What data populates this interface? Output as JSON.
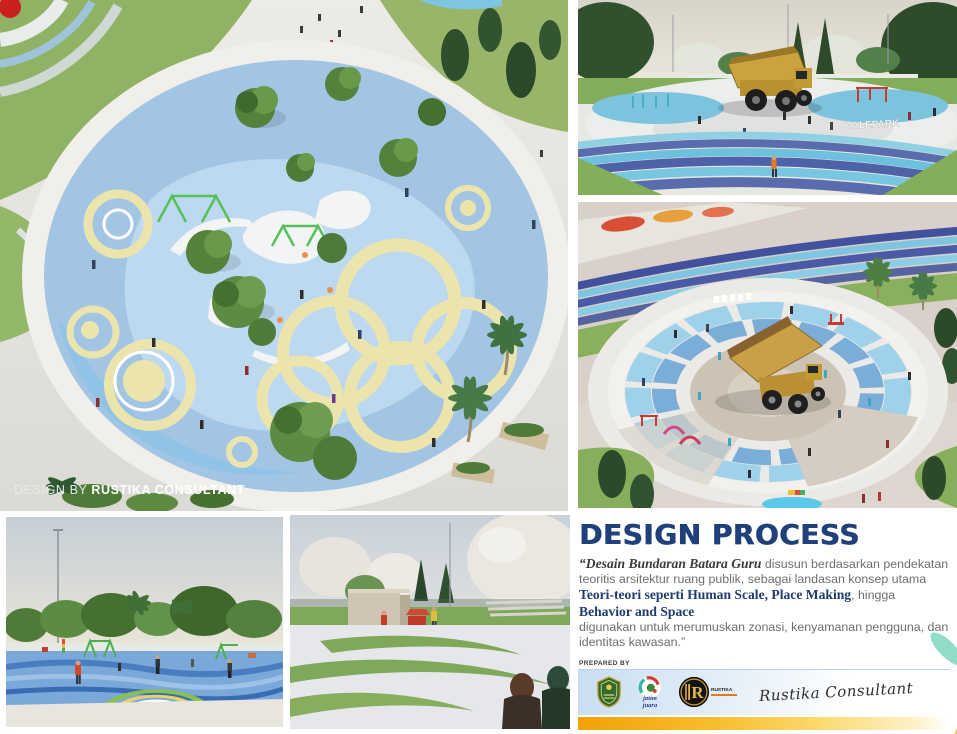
{
  "page": {
    "background": "#ffffff"
  },
  "colors": {
    "heading_navy": "#20407c",
    "body_text_gray": "#6e6e6e",
    "serif_navy": "#1e3c6e",
    "gold_bar": "#f2a106",
    "logo_band_blue": "#c9def1",
    "playground_blue": "#a2c5e4",
    "ring_cream": "#ece4ad",
    "track_blue_dark": "#5a68a8",
    "track_blue_light": "#6fc2de",
    "truck_yellow": "#caa23e",
    "emblem_teal": "#3bb8a8",
    "emblem_red": "#e02a1a"
  },
  "main_render": {
    "watermark": {
      "prefix": "DESIGN BY ",
      "name": "RUSTIKA CONSULTANT"
    }
  },
  "truck_front_render": {
    "sign_text": "VALEPARK"
  },
  "design_process": {
    "heading": "DESIGN PROCESS",
    "quote_segments": [
      {
        "text": "“Desain Bundaran Batara Guru",
        "style": "bold-italic-serif"
      },
      {
        "text": " disusun berdasarkan pendekatan teoritis arsitektur ruang publik, sebagai landasan konsep utama ",
        "style": "regular"
      },
      {
        "text": "Teori-teori seperti Human Scale, Place Making",
        "style": "bold-serif"
      },
      {
        "text": ", hingga ",
        "style": "regular"
      },
      {
        "text": "Behavior and Space",
        "style": "bold-serif"
      },
      {
        "text": " digunakan untuk merumuskan zonasi, kenyamanan pengguna, dan identitas kawasan.”",
        "style": "regular"
      }
    ],
    "prepared_by": "PREPARED BY",
    "logos": [
      {
        "name": "regency-shield-logo"
      },
      {
        "name": "jatim-juara-logo",
        "caption_line1": "jatim",
        "caption_line2": "juara"
      },
      {
        "name": "rustika-monogram-logo",
        "letter": "R",
        "caption": "RUSTIKA"
      }
    ],
    "signature": "Rustika Consultant"
  }
}
